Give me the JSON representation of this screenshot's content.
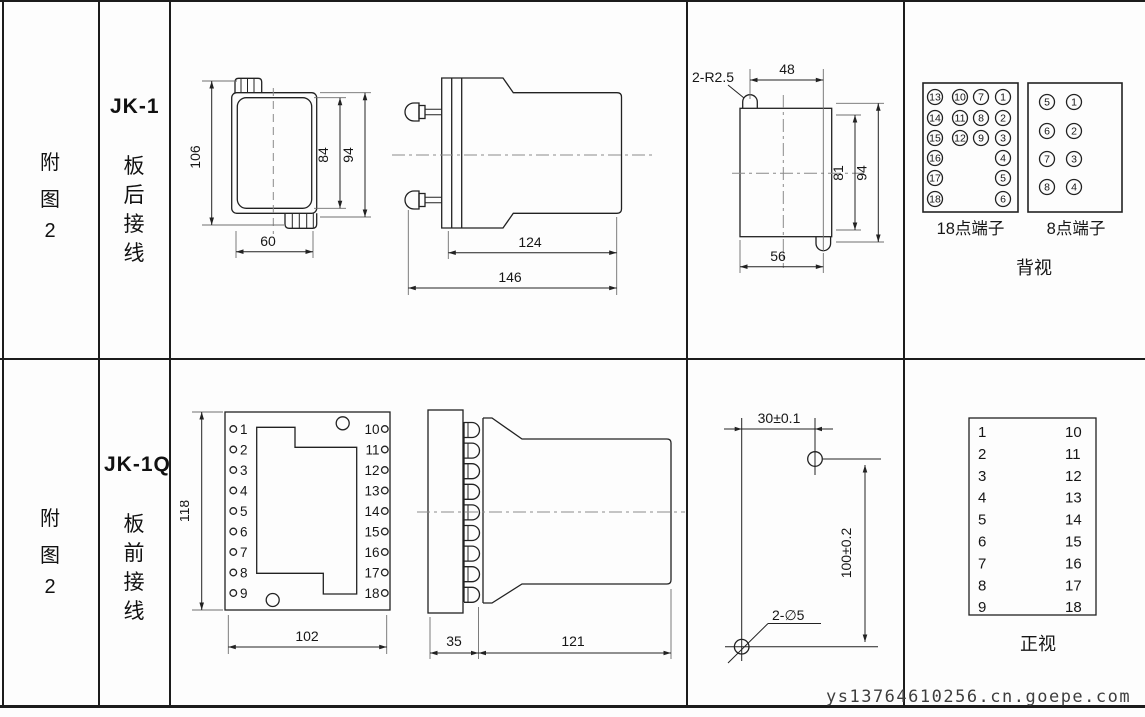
{
  "figure": {
    "label_chars": [
      "附",
      "图",
      "2"
    ]
  },
  "top_row": {
    "model": "JK-1",
    "wiring_chars": [
      "板",
      "后",
      "接",
      "线"
    ],
    "front_view": {
      "overall_height": "106",
      "inner_height": "84",
      "outer_height": "94",
      "width": "60"
    },
    "side_view": {
      "body_length": "124",
      "total_length": "146"
    },
    "panel_cutout": {
      "corner_radius": "2-R2.5",
      "top_width": "48",
      "inner_height": "81",
      "overall_height": "94",
      "bottom_width": "56"
    },
    "terminal_18": {
      "label": "18点端子",
      "grid": [
        [
          "13",
          "10",
          "7",
          "1"
        ],
        [
          "14",
          "11",
          "8",
          "2"
        ],
        [
          "15",
          "12",
          "9",
          "3"
        ],
        [
          "16",
          "",
          "",
          "4"
        ],
        [
          "17",
          "",
          "",
          "5"
        ],
        [
          "18",
          "",
          "",
          "6"
        ]
      ]
    },
    "terminal_8": {
      "label": "8点端子",
      "grid": [
        [
          "5",
          "1"
        ],
        [
          "6",
          "2"
        ],
        [
          "7",
          "3"
        ],
        [
          "8",
          "4"
        ]
      ]
    },
    "view_label": "背视"
  },
  "bottom_row": {
    "model": "JK-1Q",
    "wiring_chars": [
      "板",
      "前",
      "接",
      "线"
    ],
    "front_view": {
      "height": "118",
      "width": "102",
      "left_terminals": [
        "1",
        "2",
        "3",
        "4",
        "5",
        "6",
        "7",
        "8",
        "9"
      ],
      "right_terminals": [
        "10",
        "11",
        "12",
        "13",
        "14",
        "15",
        "16",
        "17",
        "18"
      ]
    },
    "side_view": {
      "panel_depth": "35",
      "body_length": "121"
    },
    "mounting": {
      "hole_spacing_h": "30±0.1",
      "hole_spacing_v": "100±0.2",
      "hole_note": "2-∅5"
    },
    "terminal_table": {
      "left": [
        "1",
        "2",
        "3",
        "4",
        "5",
        "6",
        "7",
        "8",
        "9"
      ],
      "right": [
        "10",
        "11",
        "12",
        "13",
        "14",
        "15",
        "16",
        "17",
        "18"
      ],
      "view_label": "正视"
    }
  },
  "watermark": "ys13764610256.cn.goepe.com"
}
